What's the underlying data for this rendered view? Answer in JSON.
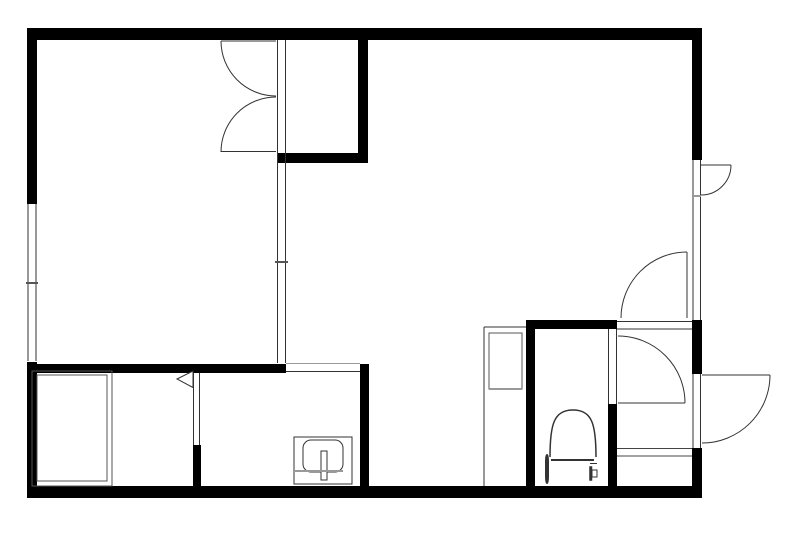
{
  "canvas": {
    "w": 800,
    "h": 534,
    "bg": "#ffffff"
  },
  "palette": {
    "wall": "#000000",
    "line": "#333333",
    "soft": "#555555",
    "gray": "#999999",
    "step": "#444444"
  },
  "walls": [
    {
      "name": "top-wall",
      "x": 27,
      "y": 28,
      "w": 675,
      "h": 12
    },
    {
      "name": "left-wall-upper",
      "x": 27,
      "y": 28,
      "w": 10,
      "h": 176
    },
    {
      "name": "left-wall-lower",
      "x": 27,
      "y": 362,
      "w": 10,
      "h": 136
    },
    {
      "name": "bottom-wall",
      "x": 27,
      "y": 486,
      "w": 675,
      "h": 12
    },
    {
      "name": "right-wall-upper",
      "x": 692,
      "y": 28,
      "w": 10,
      "h": 132
    },
    {
      "name": "right-wall-mid",
      "x": 692,
      "y": 320,
      "w": 10,
      "h": 54
    },
    {
      "name": "right-wall-lower",
      "x": 692,
      "y": 448,
      "w": 10,
      "h": 50
    },
    {
      "name": "closet-east-wall",
      "x": 358,
      "y": 40,
      "w": 10,
      "h": 123
    },
    {
      "name": "closet-south-wall",
      "x": 277,
      "y": 153,
      "w": 91,
      "h": 10
    },
    {
      "name": "washroom-north-wall",
      "x": 27,
      "y": 364,
      "w": 259,
      "h": 9
    },
    {
      "name": "washroom-east-wall",
      "x": 360,
      "y": 364,
      "w": 9,
      "h": 122
    },
    {
      "name": "bath-partition-wall",
      "x": 193,
      "y": 445,
      "w": 8,
      "h": 41
    },
    {
      "name": "toilet-west-wall",
      "x": 526,
      "y": 320,
      "w": 9,
      "h": 166
    },
    {
      "name": "toilet-north-wall",
      "x": 526,
      "y": 320,
      "w": 91,
      "h": 9
    },
    {
      "name": "toilet-east-wall",
      "x": 608,
      "y": 404,
      "w": 9,
      "h": 82
    }
  ],
  "lines": [
    {
      "name": "left-window-line-outer",
      "x1": 28,
      "y1": 204,
      "x2": 28,
      "y2": 361
    },
    {
      "name": "left-window-line-inner",
      "x1": 36,
      "y1": 204,
      "x2": 36,
      "y2": 361
    },
    {
      "name": "left-window-tick",
      "x1": 26,
      "y1": 283,
      "x2": 38,
      "y2": 283,
      "c": "soft",
      "w": 2
    },
    {
      "name": "partition-line-west",
      "x1": 277.5,
      "y1": 40,
      "x2": 277.5,
      "y2": 363
    },
    {
      "name": "partition-line-east",
      "x1": 285.5,
      "y1": 40,
      "x2": 285.5,
      "y2": 363
    },
    {
      "name": "partition-tick",
      "x1": 275,
      "y1": 262,
      "x2": 288,
      "y2": 262,
      "c": "soft",
      "w": 2
    },
    {
      "name": "right-window-line-outer",
      "x1": 700.5,
      "y1": 160,
      "x2": 700.5,
      "y2": 320
    },
    {
      "name": "right-window-line-inner",
      "x1": 693,
      "y1": 160,
      "x2": 693,
      "y2": 320
    },
    {
      "name": "right-window-tick",
      "x1": 692,
      "y1": 196,
      "x2": 701,
      "y2": 196,
      "c": "gray",
      "w": 2
    },
    {
      "name": "entry-jamb-outer",
      "x1": 700.5,
      "y1": 374,
      "x2": 700.5,
      "y2": 448
    },
    {
      "name": "entry-jamb-inner",
      "x1": 693,
      "y1": 374,
      "x2": 693,
      "y2": 448
    },
    {
      "name": "toilet-door-jamb-west",
      "x1": 608.5,
      "y1": 329,
      "x2": 608.5,
      "y2": 404
    },
    {
      "name": "toilet-door-jamb-east",
      "x1": 616.5,
      "y1": 329,
      "x2": 616.5,
      "y2": 404
    },
    {
      "name": "bath-door-jamb-west",
      "x1": 193.5,
      "y1": 373,
      "x2": 193.5,
      "y2": 445
    },
    {
      "name": "bath-door-jamb-east",
      "x1": 199.5,
      "y1": 373,
      "x2": 199.5,
      "y2": 445
    },
    {
      "name": "hall-wall-line-upper",
      "x1": 617,
      "y1": 321.5,
      "x2": 692,
      "y2": 321.5
    },
    {
      "name": "hall-wall-line-lower",
      "x1": 617,
      "y1": 329,
      "x2": 692,
      "y2": 329
    },
    {
      "name": "passage-line-upper",
      "x1": 286,
      "y1": 363.5,
      "x2": 360,
      "y2": 363.5,
      "c": "gray"
    },
    {
      "name": "passage-line-lower",
      "x1": 286,
      "y1": 371.5,
      "x2": 360,
      "y2": 371.5
    },
    {
      "name": "entry-step-line-upper",
      "x1": 617,
      "y1": 448.5,
      "x2": 692,
      "y2": 448.5,
      "c": "step"
    },
    {
      "name": "entry-step-line-lower",
      "x1": 617,
      "y1": 456,
      "x2": 692,
      "y2": 456,
      "c": "step"
    },
    {
      "name": "closet-door-upper-leaf",
      "x1": 221,
      "y1": 41,
      "x2": 276,
      "y2": 41
    },
    {
      "name": "closet-door-lower-leaf",
      "x1": 221,
      "y1": 151.5,
      "x2": 276,
      "y2": 151.5
    },
    {
      "name": "window-door-leaf",
      "x1": 701,
      "y1": 165,
      "x2": 731,
      "y2": 165
    },
    {
      "name": "living-door-leaf",
      "x1": 687,
      "y1": 252,
      "x2": 687,
      "y2": 318
    },
    {
      "name": "toilet-door-leaf",
      "x1": 618,
      "y1": 403,
      "x2": 685,
      "y2": 403
    },
    {
      "name": "entry-door-leaf",
      "x1": 702,
      "y1": 375,
      "x2": 770,
      "y2": 375
    },
    {
      "name": "cabinet-left-edge",
      "x1": 484,
      "y1": 327,
      "x2": 484,
      "y2": 486
    },
    {
      "name": "cabinet-top-edge",
      "x1": 484,
      "y1": 327,
      "x2": 526,
      "y2": 327
    }
  ],
  "arcs": [
    {
      "name": "closet-door-upper-arc",
      "d": "M221,41 A55,55 0 0 0 276,96"
    },
    {
      "name": "closet-door-lower-arc",
      "d": "M221,152 A55,55 0 0 1 276,97"
    },
    {
      "name": "window-door-arc",
      "d": "M731,165 A30,30 0 0 1 701,195"
    },
    {
      "name": "living-door-arc",
      "d": "M687,252 A66,66 0 0 0 621,318"
    },
    {
      "name": "toilet-door-arc",
      "d": "M618,336 A67,67 0 0 1 685,403"
    },
    {
      "name": "entry-door-arc",
      "d": "M770,375 A68,68 0 0 1 702,443"
    }
  ],
  "paths": [
    {
      "name": "toilet-bowl",
      "d": "M550,457 C550,424 554,410 573,410 C592,410 596,424 596,457",
      "w": 1.5
    }
  ],
  "rects": [
    {
      "name": "bathtub-outer",
      "x": 32,
      "y": 371,
      "w": 80,
      "h": 115,
      "c": "soft"
    },
    {
      "name": "bathtub-inner",
      "x": 37,
      "y": 375,
      "w": 70,
      "h": 106,
      "c": "soft"
    },
    {
      "name": "cabinet-inner-box",
      "x": 489,
      "y": 333,
      "w": 33,
      "h": 56,
      "c": "soft"
    },
    {
      "name": "sink-outer",
      "x": 294,
      "y": 437,
      "w": 58,
      "h": 47,
      "c": "line"
    },
    {
      "name": "sink-basin",
      "x": 303,
      "y": 440,
      "w": 40,
      "h": 32,
      "rx": 8,
      "c": "line"
    },
    {
      "name": "sink-faucet-lever",
      "x": 321,
      "y": 451,
      "w": 6,
      "h": 29,
      "c": "line",
      "fill": "#ffffff"
    },
    {
      "name": "toilet-tank",
      "x": 546,
      "y": 455,
      "w": 2,
      "h": 28,
      "rx": 7,
      "c": "line",
      "fill": "#ffffff"
    },
    {
      "name": "toilet-flush-button",
      "x": 590,
      "y": 467,
      "w": 1.5,
      "h": 13,
      "c": "line",
      "fill": "#ffffff"
    },
    {
      "name": "toilet-button-inner",
      "x": 592,
      "y": 470,
      "w": 5,
      "h": 7,
      "c": "line"
    }
  ],
  "overlines": [
    {
      "name": "toilet-tank-top-line",
      "x1": 551,
      "y1": 460,
      "x2": 594,
      "y2": 460,
      "c": "line",
      "w": 2
    },
    {
      "name": "toilet-tank-tick",
      "x1": 590,
      "y1": 463.5,
      "x2": 597,
      "y2": 463.5,
      "c": "line",
      "w": 1
    },
    {
      "name": "cabinet-inner-bottom-line",
      "x1": 489,
      "y1": 389,
      "x2": 522,
      "y2": 389,
      "c": "gray",
      "w": 2
    },
    {
      "name": "sink-counter-line",
      "x1": 294,
      "y1": 471,
      "x2": 343,
      "y2": 471,
      "c": "gray",
      "w": 2
    }
  ],
  "polygons": [
    {
      "name": "bath-door-symbol",
      "points": "177,379 193,371 193,387.5",
      "fill": "#ffffff",
      "c": "line"
    }
  ]
}
